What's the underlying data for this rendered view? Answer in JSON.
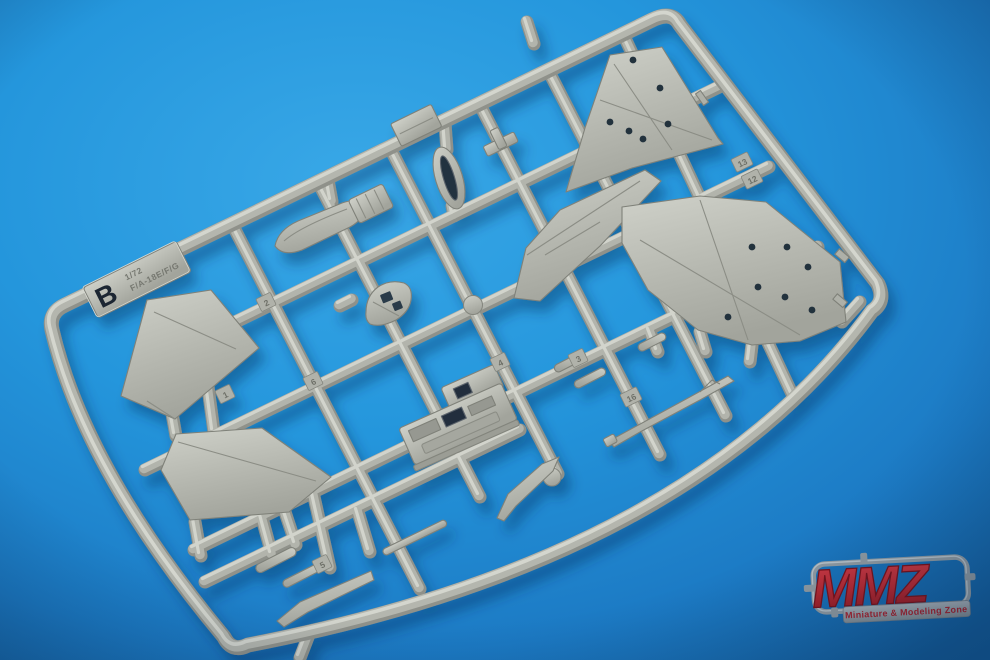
{
  "photo": {
    "background": {
      "center_color": "#2e9fe2",
      "mid_color": "#1f86cf",
      "edge_color": "#145e9e"
    },
    "sprue": {
      "plastic_color": "#b6b8b0",
      "plastic_highlight": "#d0d2ca",
      "plastic_shadow": "#90928a",
      "letter_tag": {
        "letter": "B",
        "scale": "1/72",
        "subject": "F/A-18E/F/G"
      },
      "part_number_tags": [
        {
          "label": "2"
        },
        {
          "label": "6"
        },
        {
          "label": "1"
        },
        {
          "label": "4"
        },
        {
          "label": "3"
        },
        {
          "label": "16"
        },
        {
          "label": "13"
        },
        {
          "label": "12"
        },
        {
          "label": "5"
        }
      ]
    },
    "watermark": {
      "name": "MMZ",
      "tagline": "Miniature & Modeling Zone",
      "letter_color": "#c1272d",
      "frame_color": "#98a0a5"
    }
  }
}
